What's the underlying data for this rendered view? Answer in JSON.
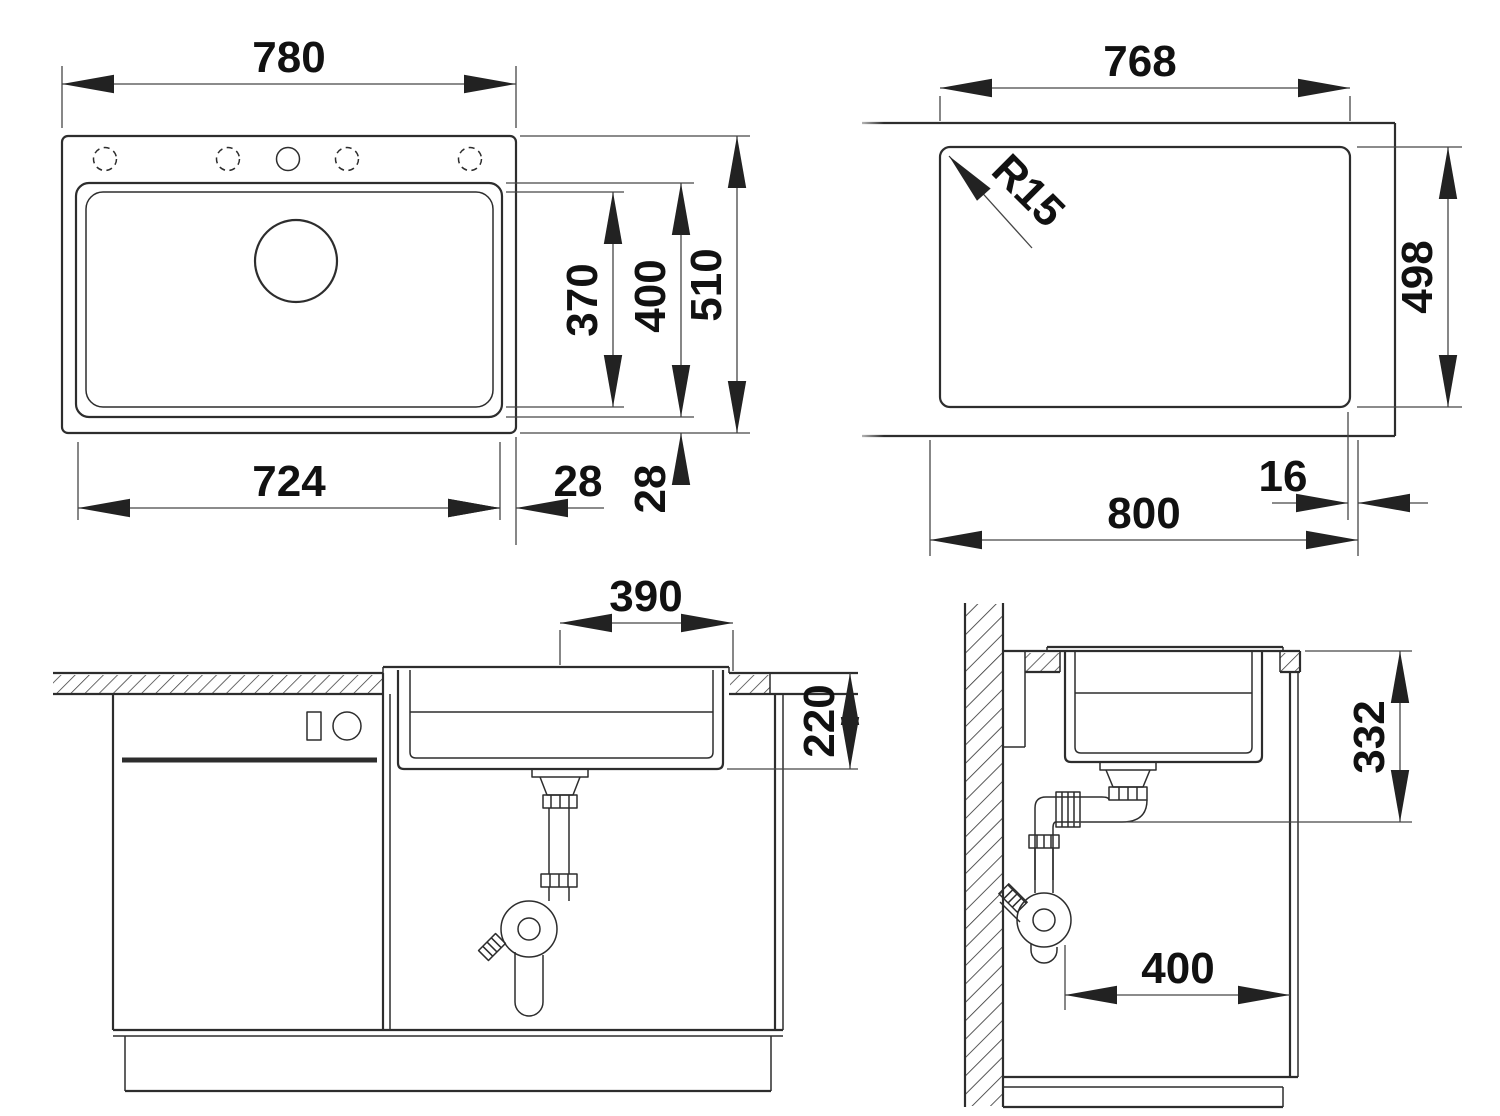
{
  "colors": {
    "background": "#ffffff",
    "outline": "#2d2d2d",
    "dimension_lines": "#464646",
    "text": "#111111"
  },
  "views": {
    "top_view": {
      "dims": {
        "overall_width": "780",
        "overall_depth": "510",
        "bowl_width": "724",
        "bowl_depth_inner": "370",
        "bowl_depth_outer": "400",
        "side_margin": "28",
        "bottom_margin": "28"
      }
    },
    "cutout_view": {
      "dims": {
        "cutout_width": "768",
        "cutout_depth": "498",
        "corner_radius": "R15",
        "overall_width": "800",
        "edge_offset": "16"
      }
    },
    "front_section": {
      "dims": {
        "bowl_center_to_edge": "390",
        "bowl_depth": "220"
      }
    },
    "side_section": {
      "dims": {
        "outlet_height": "332",
        "base_cabinet_depth": "400"
      }
    }
  }
}
